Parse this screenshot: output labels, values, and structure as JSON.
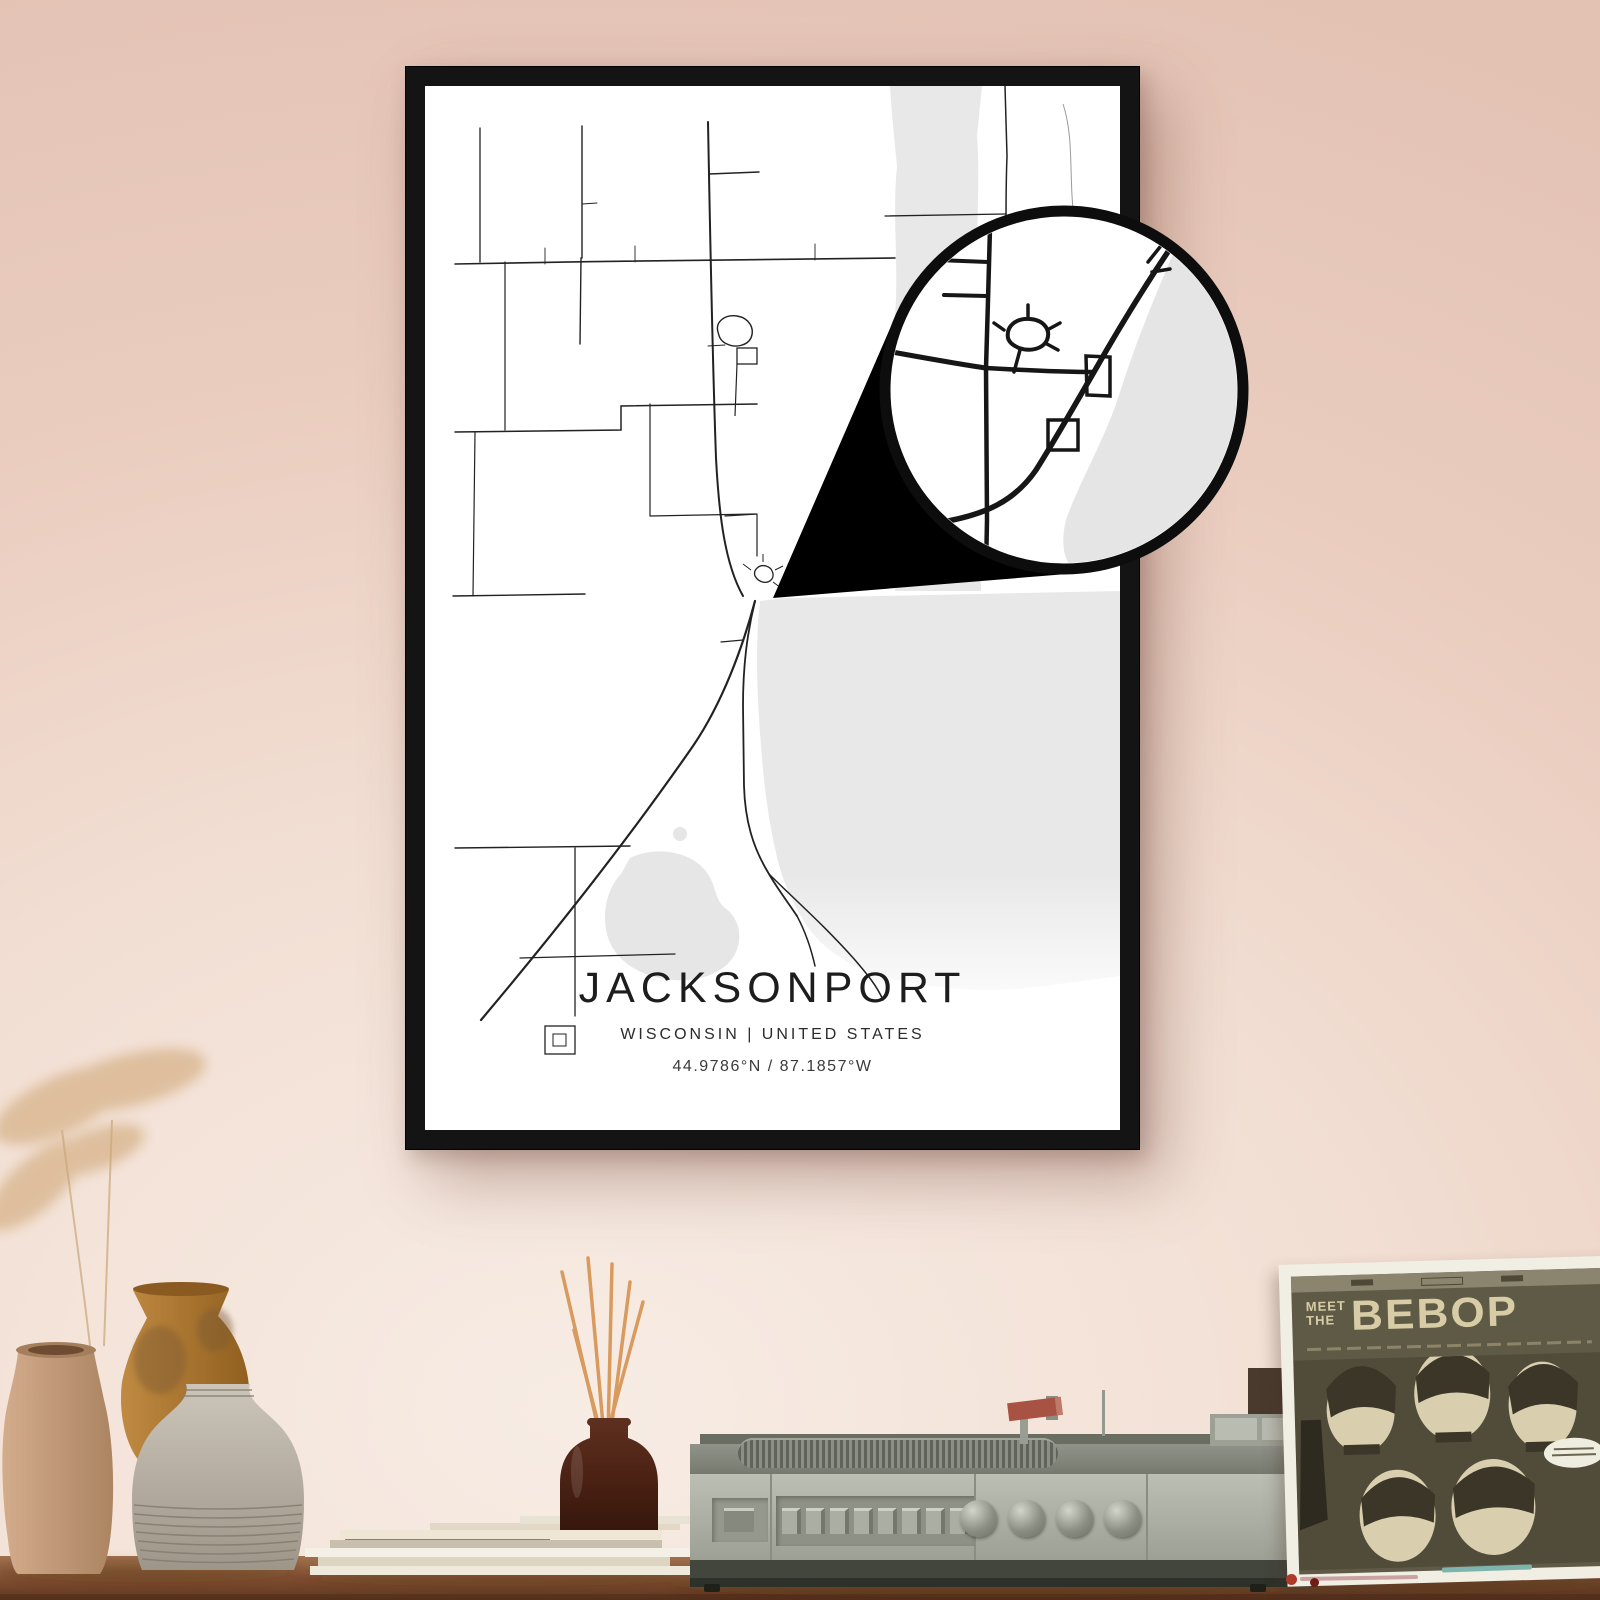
{
  "poster": {
    "title": "JACKSONPORT",
    "region_line": "WISCONSIN | UNITED STATES",
    "coordinates": "44.9786°N / 87.1857°W",
    "frame_color": "#141414",
    "map": {
      "land": "#ffffff",
      "water": "#e8e8e8",
      "road": "#1f1f1f"
    }
  },
  "magnifier": {
    "ring_color": "#0d0d0d",
    "wedge_color": "#000000",
    "fill": "#ffffff"
  },
  "sleeve": {
    "meet": "MEET",
    "the": "THE",
    "bebop": "BEBOP",
    "bg": "#5f5a46",
    "text_color": "#d8cca6"
  },
  "scene_colors": {
    "wall_top": "#e3c2b4",
    "wall_light": "#f7ece4",
    "table": "#8a5a3c",
    "radio_body": "#b0b3a8",
    "diffuser_bottle": "#46241a",
    "reed_sticks": "#d99a5e",
    "vase_tan": "#c59b79",
    "vase_amber": "#b5803b",
    "vase_gray": "#b5ada0"
  }
}
